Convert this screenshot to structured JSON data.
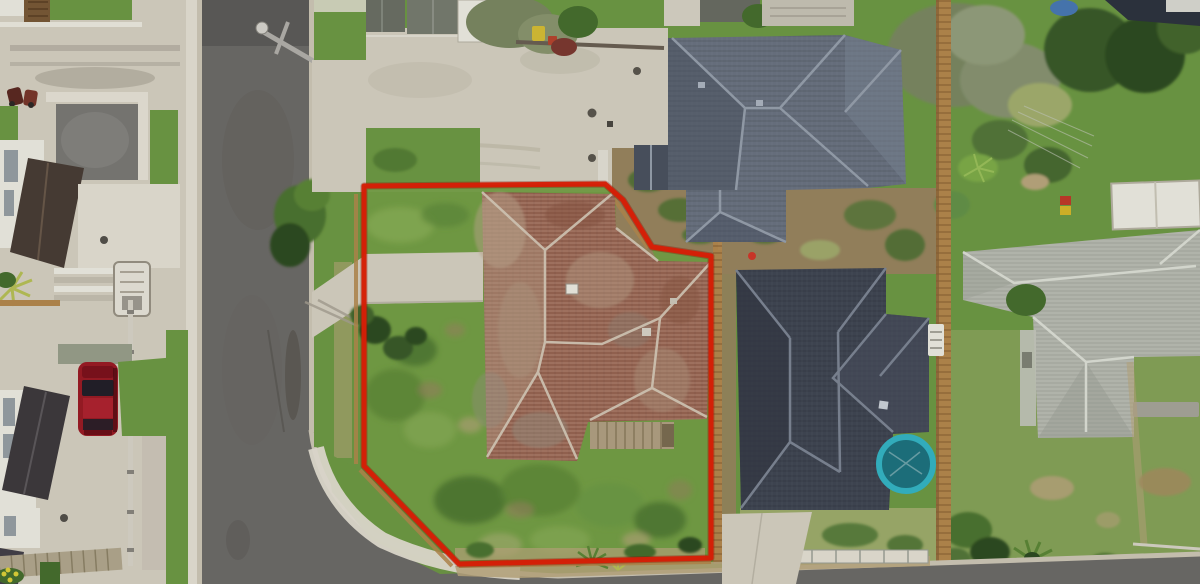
{
  "meta": {
    "type": "aerial-drone-photograph",
    "subject": "Top-down aerial view of a suburban corner section outlined in red",
    "image_width": 1200,
    "image_height": 584
  },
  "annotation": {
    "name": "property-boundary",
    "points": "364,186 605,184 623,200 652,247 711,256 711,558 459,564 364,466",
    "stroke_width": 5
  },
  "scene": {
    "description": "Aerial photo of a corner residential lot outlined in red containing an old red-tile hip-roof house on an overgrown lawn; a shared concrete driveway runs along the top, a grey street wraps the left and bottom, two dark slate-roofed houses sit to the right behind a timber fence, with neighbouring gardens, a grey-roofed house far right, a blue trampoline and a red parked car across the street.",
    "objects": [
      {
        "name": "road",
        "label": "Suburban street (asphalt)"
      },
      {
        "name": "property-boundary",
        "label": "Red property boundary outline"
      },
      {
        "name": "subject-house",
        "label": "Weathered red-tile hip-roof house"
      },
      {
        "name": "subject-yard",
        "label": "Overgrown grass section"
      },
      {
        "name": "shared-driveway",
        "label": "Shared concrete driveway"
      },
      {
        "name": "neighbour-house-north",
        "label": "Dark slate hip-roof house (rear neighbour)"
      },
      {
        "name": "neighbour-house-east",
        "label": "Charcoal hip-roof house (side neighbour)"
      },
      {
        "name": "neighbour-house-far-right",
        "label": "Grey-roof neighbouring house"
      },
      {
        "name": "trampoline",
        "label": "Blue trampoline"
      },
      {
        "name": "parked-car",
        "label": "Red car parked on driveway"
      },
      {
        "name": "timber-fence",
        "label": "Timber boundary fence"
      },
      {
        "name": "power-pole",
        "label": "Street power pole"
      },
      {
        "name": "garden-trees",
        "label": "Mature garden trees and shrubs"
      },
      {
        "name": "west-houses",
        "label": "Neighbouring houses west of the street"
      },
      {
        "name": "footpath",
        "label": "Concrete footpath and kerb"
      },
      {
        "name": "deck-stairs",
        "label": "Timber deck and steps"
      },
      {
        "name": "white-shed",
        "label": "White garden shed"
      }
    ]
  },
  "colors": {
    "grass": "#6f9b45",
    "grassLight": "#8db35a",
    "grassDark": "#47702f",
    "grassPale": "#a4b070",
    "dirt": "#9a8660",
    "dirtLight": "#bba87e",
    "road": "#6e6c69",
    "roadDark": "#5c5a58",
    "kerb": "#cfc8b8",
    "concrete": "#d7d2c3",
    "concreteLight": "#e6e2d5",
    "concreteShadow": "#b4afa0",
    "slateRoof": "#6b7483",
    "slateDark": "#4c5361",
    "slateRidge": "#98a1ae",
    "charRoof": "#414754",
    "charRidge": "#7e8796",
    "tileRoof": "#a2705d",
    "tileLight": "#bfa78f",
    "tileRidge": "#d9cebc",
    "grayRoof": "#b7bab0",
    "grayDark": "#9da199",
    "grayRidge": "#dfe2d8",
    "white": "#efede4",
    "fence": "#b5894e",
    "fenceDark": "#8a6437",
    "boundary": "#e32007",
    "car": "#9c1c26",
    "carGlass": "#23202a",
    "trampoline": "#35b6c6",
    "trampolineDark": "#1e7480",
    "treeDark": "#2f4d23",
    "treeMid": "#4d7632",
    "treeOlive": "#7c8963",
    "pole": "#b3b1ac",
    "window": "#98a0a6",
    "binYellow": "#d7bf35",
    "binMaroon": "#7d3a31"
  }
}
